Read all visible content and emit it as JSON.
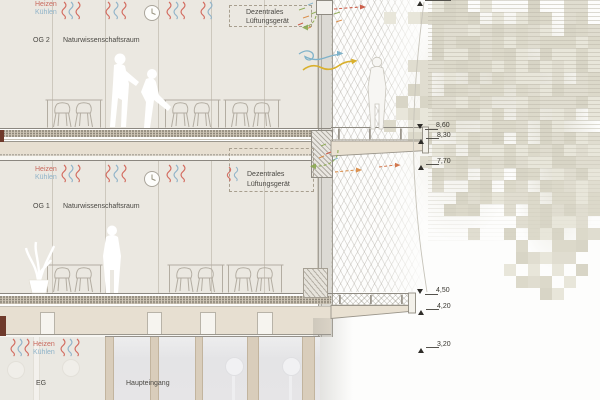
{
  "drawing_type": "building-section",
  "floors": {
    "og2": {
      "label": "OG 2",
      "room": "Naturwissenschaftsraum"
    },
    "og1": {
      "label": "OG 1",
      "room": "Naturwissenschaftsraum"
    },
    "eg": {
      "label": "EG",
      "room": "Haupteingang"
    }
  },
  "climate": {
    "heating": "Heizen",
    "cooling": "Kühlen"
  },
  "vent": {
    "line1": "Dezentrales",
    "line2": "Lüftungsgerät"
  },
  "elevation_markers": [
    {
      "value": "8,60",
      "direction": "down"
    },
    {
      "value": "8,30",
      "direction": "up"
    },
    {
      "value": "7,70",
      "direction": "up"
    },
    {
      "value": "4,50",
      "direction": "down"
    },
    {
      "value": "4,20",
      "direction": "up"
    },
    {
      "value": "3,20",
      "direction": "up"
    }
  ],
  "colors": {
    "heating": "#d2685c",
    "cooling": "#8fb3c9",
    "supply_air": "#8aa84e",
    "exhaust_air": "#c8503a",
    "warm_exhaust": "#d9863d",
    "breeze": "#7fb2c9",
    "solar": "#d9b02c",
    "slab_cut_accent": "#6f3a2b"
  },
  "icons": {
    "clock": "clock-icon",
    "airflow": "airflow-squiggle-icon",
    "elevation_up": "triangle-up-icon",
    "elevation_down": "triangle-down-icon"
  }
}
